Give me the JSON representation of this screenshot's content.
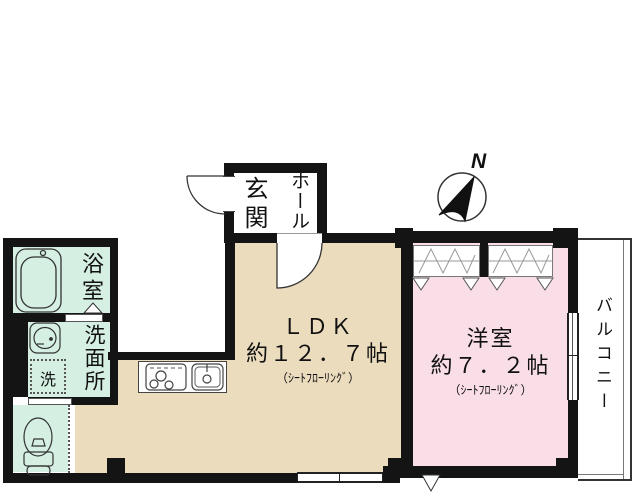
{
  "title": "間取り図",
  "colors": {
    "ldk_floor": "#ebdcbe",
    "wet_floor": "#d5f0e3",
    "western_floor": "#fadee7",
    "wall": "#141414"
  },
  "rooms": {
    "genkan": {
      "label": "玄関"
    },
    "hall": {
      "label": "ホール"
    },
    "bathroom": {
      "label": "浴室"
    },
    "washroom": {
      "label": "洗面所"
    },
    "washer": {
      "label": "洗"
    },
    "ldk": {
      "name": "ＬＤＫ",
      "area": "約１２．７帖",
      "flooring": "（ｼｰﾄﾌﾛｰﾘﾝｸﾞ）"
    },
    "western": {
      "name": "洋室",
      "area": "約７．２帖",
      "flooring": "（ｼｰﾄﾌﾛｰﾘﾝｸﾞ）"
    },
    "balcony": {
      "label": "バルコニー"
    }
  },
  "compass": {
    "north_label": "N"
  },
  "icons": {
    "bathtub": "bathtub-icon",
    "vanity_sink": "vanity-sink-icon",
    "washer_box": "washing-machine-icon",
    "toilet": "toilet-icon",
    "stove": "stove-burner-icon",
    "kitchen_sink": "kitchen-sink-icon",
    "compass": "north-compass-icon"
  }
}
